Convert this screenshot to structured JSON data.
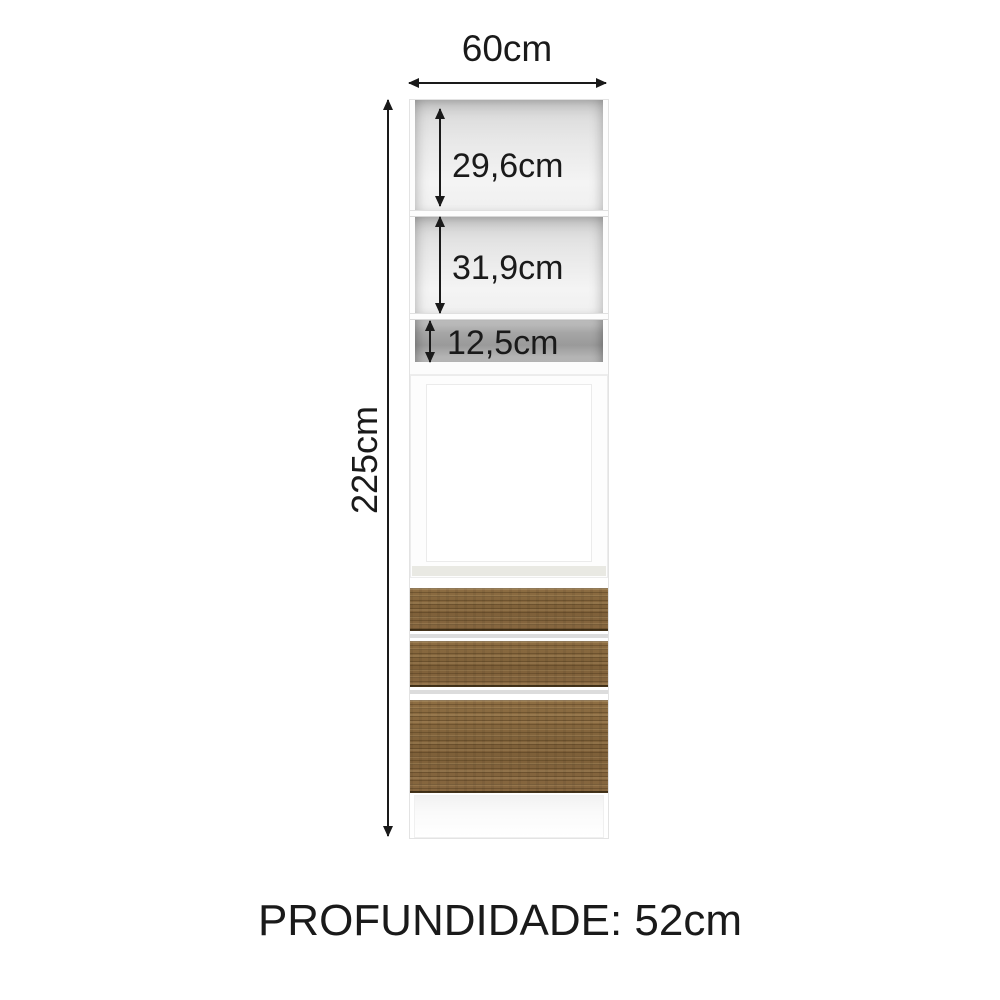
{
  "diagram": {
    "width_label": "60cm",
    "height_label": "225cm",
    "sections": [
      {
        "label": "29,6cm"
      },
      {
        "label": "31,9cm"
      },
      {
        "label": "12,5cm"
      }
    ],
    "depth_label": "PROFUNDIDADE: 52cm"
  },
  "colors": {
    "text": "#1a1a1a",
    "arrow": "#1a1a1a",
    "wood": "#85663e",
    "cabinet_white": "#fdfdfd",
    "interior_gray": "#e3e3e3",
    "niche_gray": "#9d9d9d"
  }
}
